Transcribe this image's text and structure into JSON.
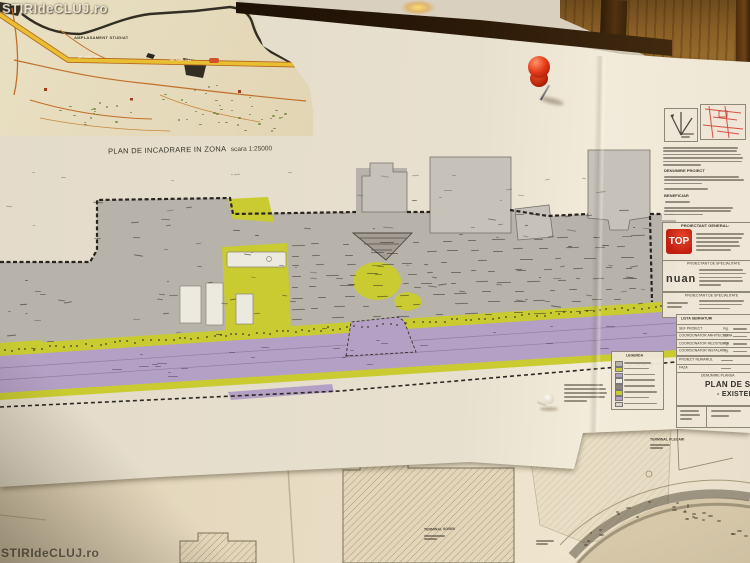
{
  "photo": {
    "watermark_top": "STIRIdeCLUJ.ro",
    "watermark_bottom": "STIRIdeCLUJ.ro"
  },
  "inset_map": {
    "area_label": "AMPLASAMENT STUDIAT",
    "road_label_left": "Str. Traian Vuia",
    "road_label_right": "Str. Traian Vuia",
    "caption_title": "PLAN DE INCADRARE IN ZONA",
    "caption_scale": "scara 1:25000"
  },
  "site_plan": {
    "legend_title": "LEGENDA",
    "legend_swatches": [
      "#b7b3ab",
      "#c9cb31",
      "#b5a0c5",
      "#eceadf",
      "#8b8478",
      "#c9cb31",
      "#b5a0c5",
      "#d8d2c2"
    ],
    "colors": {
      "apron": "#b7b3ab",
      "grass": "#c9cb31",
      "road": "#b5a0c5",
      "paper": "#e8e0cf"
    }
  },
  "title_block": {
    "denumire_heading": "DENUMIRE PROIECT",
    "beneficiar_heading": "BENEFICIAR",
    "proiectant_general_heading": "PROIECTANT GENERAL:",
    "proiectant_general_logo": "TOP",
    "specialitate_heading_1": "PROIECTANT DE SPECIALITATE",
    "specialitate_logo_1": "nuan",
    "specialitate_heading_2": "PROIECTANT DE SPECIALITATE",
    "lista_semnaturi_heading": "LISTA SEMNATURI",
    "signature_rows": [
      {
        "role": "SEF PROIECT",
        "grade": "ing."
      },
      {
        "role": "COORDONATOR ARHITECTURA",
        "grade": "arh."
      },
      {
        "role": "COORDONATOR REZISTENTA",
        "grade": "ing."
      },
      {
        "role": "COORDONATOR INSTALATII",
        "grade": "ing."
      }
    ],
    "proiect_numarul_label": "PROIECT NUMARUL",
    "faza_label": "FAZA",
    "denumire_plansa_label": "DENUMIRE PLANSA",
    "sheet_title_line1": "PLAN DE SITUATIE",
    "sheet_title_line2": "- EXISTENT"
  },
  "lower_sheet": {
    "terminal_label_1": "TERMINAL SOSIRI",
    "terminal_label_2": "TERMINAL PLECARI"
  }
}
